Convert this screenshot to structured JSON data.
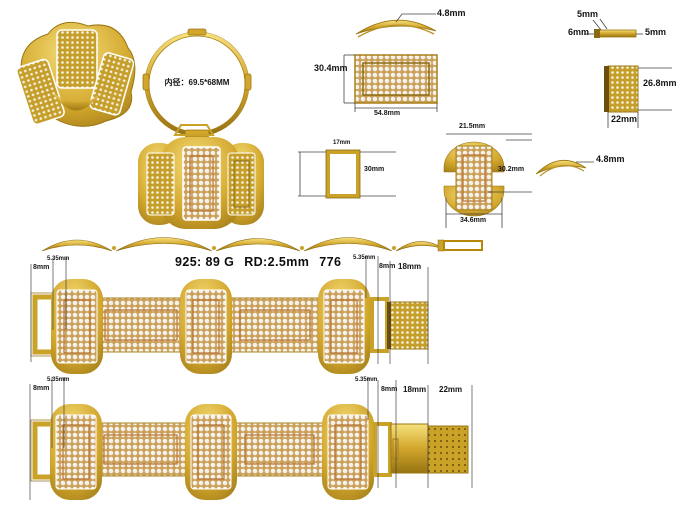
{
  "sheet": {
    "background": "#ffffff"
  },
  "colors": {
    "gold": "#d2a62c",
    "gold_light": "#f6e07c",
    "gold_dark": "#8a6a12",
    "bronze": "#b87333",
    "stone_white": "#f4efe6",
    "dim_line": "#444444",
    "text": "#141414"
  },
  "views": {
    "perspective": {
      "name": "bracelet-3d-view"
    },
    "ring_profile": {
      "inner_diameter": "内径：69.5*68MM"
    },
    "top_arc": {
      "thickness": "4.8mm"
    },
    "end_bar": {
      "top": "5mm",
      "left": "6mm",
      "right": "5mm"
    },
    "center_plate": {
      "height": "30.4mm",
      "width": "54.8mm"
    },
    "clasp_box": {
      "height": "26.8mm",
      "width": "22mm"
    },
    "tube": {
      "width": "17mm",
      "height": "30mm"
    },
    "link": {
      "top_width": "21.5mm",
      "height": "30.2mm",
      "bottom_width": "34.6mm"
    },
    "side_arc": {
      "thickness": "4.8mm"
    },
    "spec": {
      "metal": "925: 89 G",
      "stone": "RD:2.5mm",
      "code": "776"
    },
    "bracelet_a": {
      "left_labels": [
        "8mm",
        "5.35mm"
      ],
      "right_labels": [
        "5.35mm",
        "8mm",
        "18mm"
      ]
    },
    "bracelet_b": {
      "left_labels": [
        "8mm",
        "5.35mm"
      ],
      "right_labels": [
        "5.35mm",
        "8mm",
        "18mm",
        "22mm"
      ]
    }
  }
}
